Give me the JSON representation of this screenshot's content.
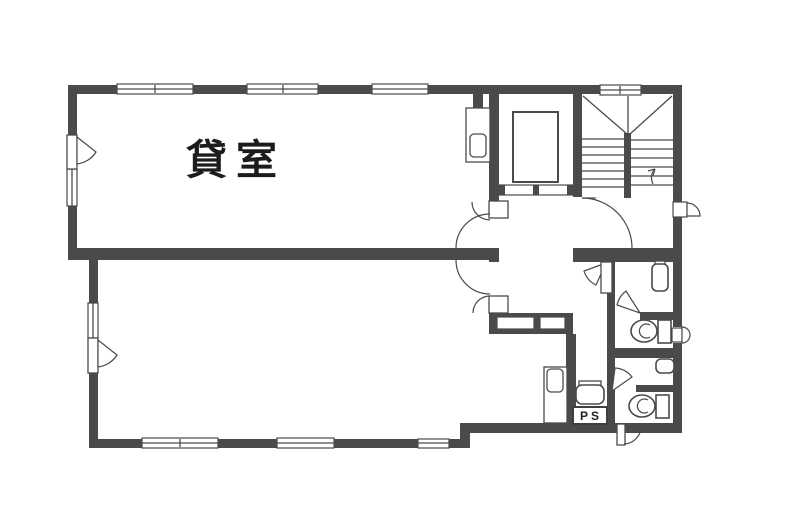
{
  "page": {
    "type": "architectural-floor-plan",
    "background_color": "#ffffff"
  },
  "floor_plan": {
    "room_label": "貸室",
    "pipe_space_label": "PS",
    "colors": {
      "wall": "#4a4a4a",
      "line": "#4a4a4a",
      "text": "#1c1c1c",
      "fill": "#ffffff"
    },
    "fixtures": [
      "elevator",
      "u-turn-staircase",
      "stair-direction-arrow",
      "toilet",
      "toilet",
      "wash-basin",
      "hand-sink",
      "utility-sink",
      "service-counter",
      "service-counter"
    ]
  }
}
